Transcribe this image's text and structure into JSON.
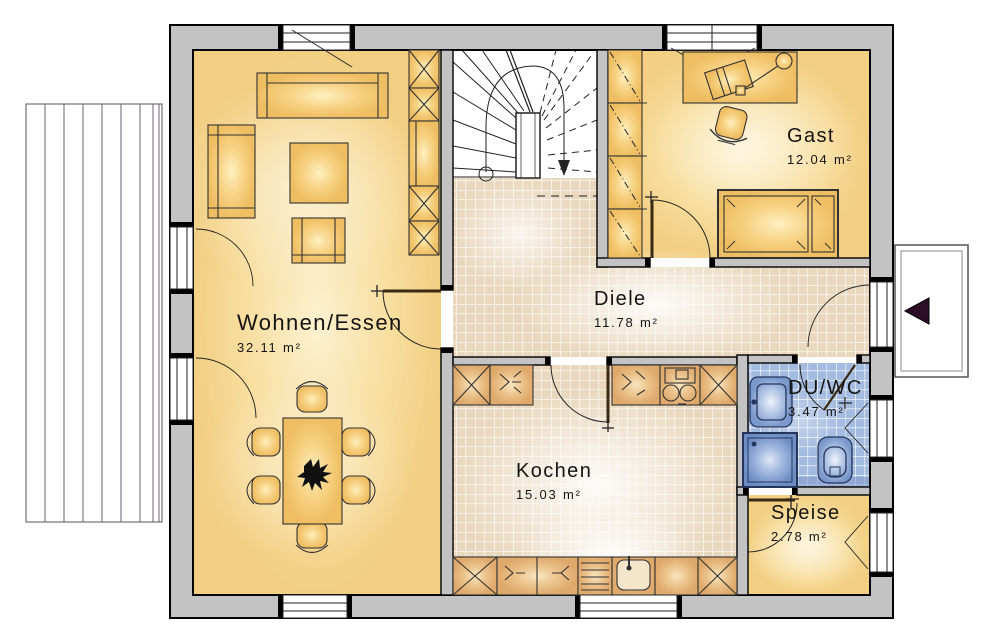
{
  "plan": {
    "type": "floor-plan",
    "rooms": [
      {
        "name": "Wohnen/Essen",
        "area": "32.11 m²"
      },
      {
        "name": "Diele",
        "area": "11.78 m²"
      },
      {
        "name": "Gast",
        "area": "12.04 m²"
      },
      {
        "name": "Kochen",
        "area": "15.03 m²"
      },
      {
        "name": "DU/WC",
        "area": "3.47 m²"
      },
      {
        "name": "Speise",
        "area": "2.78 m²"
      }
    ],
    "icons": {
      "entrance_arrow": "left-pointing-triangle"
    },
    "colors": {
      "wall": "#c3c3c3",
      "floor_yellow": "#f6d58e",
      "tile_beige": "#e9d8bd",
      "tile_blue": "#a3bbdf",
      "fixture_blue": "#8fa8d8",
      "furniture": "#f3c97e",
      "cabinet": "#e2b07c",
      "entrance_arrow": "#2e0d28",
      "deck_line": "#6f5f71"
    }
  }
}
